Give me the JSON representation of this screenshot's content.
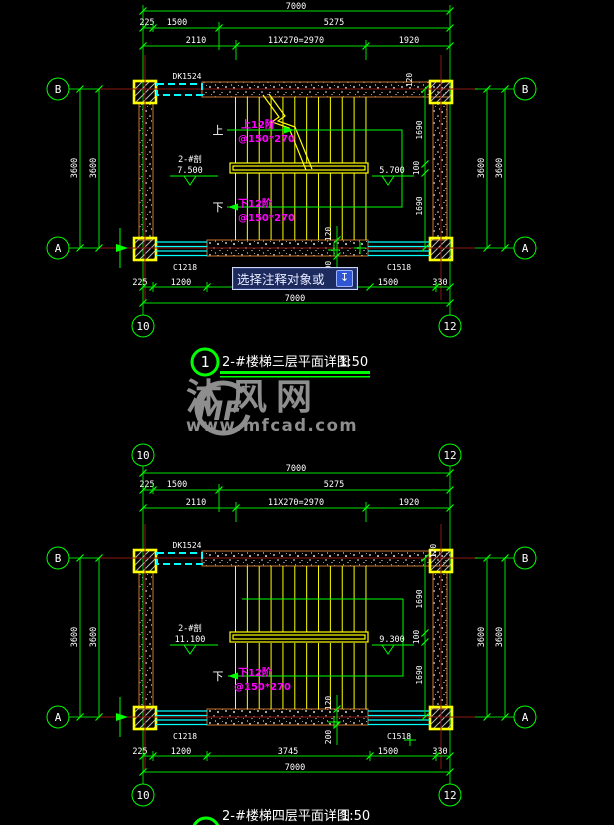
{
  "tooltip": {
    "text": "选择注释对象或",
    "icon": "↧"
  },
  "watermark": {
    "logo": "MF",
    "star": "+",
    "name": "沐风网",
    "url": "www.mfcad.com"
  },
  "top_plan": {
    "door_label": "DK1524",
    "grid": {
      "b": "B",
      "a": "A",
      "n10": "10",
      "n12": "12"
    },
    "dim_total": "7000",
    "dim_r2": [
      "225",
      "1500",
      "5275"
    ],
    "dim_r3": [
      "2110",
      "11X270=2970",
      "1920"
    ],
    "dim_left": [
      "3600",
      "3600"
    ],
    "dim_right": [
      "3600",
      "3600"
    ],
    "dim_right_inner": [
      "120",
      "1690",
      "100",
      "1690"
    ],
    "dim_mid": [
      "120",
      "200"
    ],
    "dim_bottom": [
      "225",
      "1200",
      "1500",
      "330"
    ],
    "dim_bottom_total": "7000",
    "window_left": "C1218",
    "window_right": "C1518",
    "level_left_mark": "2-#剖",
    "level_left_value": "7.500",
    "level_right_value": "5.700",
    "up_label": "上",
    "up_text1": "上12阶",
    "up_text2": "@150*270",
    "down_label": "下",
    "down_text1": "下12阶",
    "down_text2": "@150*270",
    "title_num": "1",
    "title_text": "2-#楼梯三层平面详图",
    "title_scale": "1:50"
  },
  "bottom_plan": {
    "door_label": "DK1524",
    "grid": {
      "b": "B",
      "a": "A",
      "n10": "10",
      "n12": "12"
    },
    "dim_total": "7000",
    "dim_r2": [
      "225",
      "1500",
      "5275"
    ],
    "dim_r3": [
      "2110",
      "11X270=2970",
      "1920"
    ],
    "dim_left": [
      "3600",
      "3600"
    ],
    "dim_right": [
      "3600",
      "3600"
    ],
    "dim_right_inner": [
      "120",
      "1690",
      "100",
      "1690"
    ],
    "dim_mid": [
      "120",
      "200"
    ],
    "dim_bottom": [
      "225",
      "1200",
      "3745",
      "1500",
      "330"
    ],
    "dim_bottom_total": "7000",
    "window_left": "C1218",
    "window_right": "C1518",
    "level_left_mark": "2-#剖",
    "level_left_value": "11.100",
    "level_right_value": "9.300",
    "down_label": "下",
    "down_text1": "下12阶",
    "down_text2": "@150*270",
    "title_num": "2",
    "title_text": "2-#楼梯四层平面详图",
    "title_scale": "1:50"
  }
}
